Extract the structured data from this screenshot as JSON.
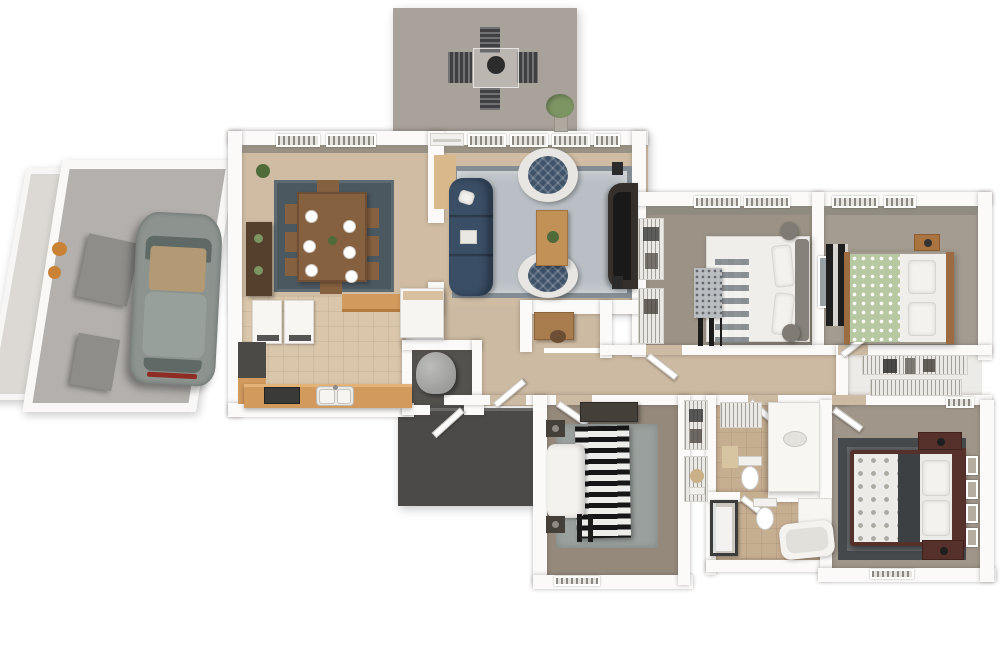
{
  "scene": {
    "type": "3d-floorplan-render",
    "description": "Top-down 3D architectural rendering of a single-story 3-bedroom, 2-bath house with attached garage and parked car, rear patio with outdoor dining set, open-plan dining and living rooms, kitchen with laundry pair, utility closet with water heater, dark concrete entry porch, central hallway, wire-shelf closets, two shared-wall bedrooms, hall bathroom, master bathroom and master bedroom",
    "background": "#ffffff",
    "visible_text": ""
  },
  "palette": {
    "background": "#ffffff",
    "wall": "#fbfaf8",
    "wall_face": "#8e897f",
    "patio_floor": "#a8a29a",
    "sideyard_floor": "#dcd9d4",
    "garage_floor": "#b3b0ad",
    "carpet_main": "#cfbca3",
    "kitchen_tile": "#d9c6ab",
    "hall_carpet": "#cdbaa2",
    "bedroom1_floor": "#9c9386",
    "bedroom2_floor": "#a49c90",
    "bedroom3_floor": "#95897b",
    "master_floor": "#a0968a",
    "bath_tile": "#c6ae91",
    "closet_floor": "#edebe7",
    "porch_concrete": "#4b4a48",
    "utility_floor": "#54524f",
    "dining_rug": "#4c5860",
    "living_rug": "#b9bfc4",
    "bedroom3_rug": "#9aa09d",
    "master_rug": "#55585b",
    "sofa_navy": "#3a4e66",
    "armchair_navy": "#3e5269",
    "chair_shell_white": "#e8e6e2",
    "wood_dark": "#55402e",
    "wood_table": "#86613f",
    "wood_light": "#c29158",
    "cabinet_wood": "#d29a5c",
    "counter_dark": "#4b4a47",
    "car_body": "#8d9490",
    "car_glass": "#5f6a66",
    "car_interior": "#b49a74",
    "car_taillight": "#8f2d24",
    "tv_dark": "#35302c",
    "speaker_dark": "#2b2b2b",
    "bed_white": "#f0eeea",
    "green_duvet": "#b7c8a3",
    "master_frame": "#56302b",
    "dark_furniture": "#453f3a",
    "grey_blanket": "#b9bdbf",
    "dark_fold": "#3d4043",
    "headboard_grey": "#86827b",
    "pouf_grey": "#7f7b74",
    "pot_orange": "#c98236",
    "plant_green": "#7d9463",
    "plant_dark": "#4f6b3a",
    "storage_grey": "#8e8d8a",
    "water_heater": "#a5a5a3",
    "porcelain": "#f7f6f3",
    "firebowl_dark": "#2c2c2c",
    "outdoor_chair": "#3f4041",
    "wood_floor_strip": "#d9b98c",
    "basket_tan": "#c9b089"
  },
  "rooms": [
    {
      "id": "patio",
      "label": "Rear patio",
      "furniture": [
        "outdoor dining table",
        "fire bowl",
        "4 slat chairs",
        "potted plant"
      ]
    },
    {
      "id": "side-yard",
      "label": "Side yard strip",
      "furniture": [
        "two orange planter pots",
        "angled grey partitions"
      ]
    },
    {
      "id": "garage",
      "label": "Garage",
      "furniture": [
        "parked grey car",
        "two grey storage units"
      ]
    },
    {
      "id": "dining-room",
      "label": "Dining room",
      "furniture": [
        "wood table with 6 place settings",
        "8 chairs",
        "dark blue-grey rug",
        "sideboard",
        "corner plant"
      ]
    },
    {
      "id": "living-room",
      "label": "Living room",
      "furniture": [
        "navy 3-seat sofa",
        "two round tub chairs",
        "wood coffee table with plant",
        "large grey rug",
        "TV console",
        "two speakers",
        "wood floor strip at patio door"
      ]
    },
    {
      "id": "kitchen",
      "label": "Kitchen / laundry",
      "furniture": [
        "washer",
        "dryer",
        "dark counter",
        "wood base cabinets",
        "double sink",
        "dark cooktop",
        "upper counter strip",
        "white island"
      ]
    },
    {
      "id": "utility-closet",
      "label": "Utility closet",
      "furniture": [
        "water heater cylinder"
      ]
    },
    {
      "id": "entry-porch",
      "label": "Entry porch (outdoor)",
      "furniture": [
        "front door leaf",
        "utility door leaf"
      ]
    },
    {
      "id": "entry-hall",
      "label": "Entry / hallway",
      "furniture": [
        "door leafs"
      ]
    },
    {
      "id": "office-nook",
      "label": "Office nook",
      "furniture": [
        "wood desk",
        "desk chair"
      ]
    },
    {
      "id": "bedroom-1",
      "label": "Bedroom 1 (top middle)",
      "furniture": [
        "bed with white and plaid bedding",
        "grey dotted throw",
        "dark luggage-rack bars",
        "two grey poufs",
        "double reach-in wire closets"
      ]
    },
    {
      "id": "bedroom-2",
      "label": "Bedroom 2 (top right)",
      "furniture": [
        "bed with green floral duvet",
        "wood head and foot rails",
        "wood nightstand with lamp",
        "dark shelf unit",
        "wall art"
      ]
    },
    {
      "id": "hall-closet",
      "label": "Walk-through wire closet",
      "furniture": [
        "two hanging-clothes shelf rows"
      ]
    },
    {
      "id": "bedroom-3",
      "label": "Bedroom 3 (bottom left)",
      "furniture": [
        "bed with black-white striped duvet",
        "white crumpled blanket",
        "grey rug",
        "dark dresser",
        "two dark nightstands",
        "dark foot bench"
      ]
    },
    {
      "id": "bathroom",
      "label": "Hall bathroom",
      "furniture": [
        "white vanity",
        "toilet",
        "wire shelf",
        "bath mat"
      ]
    },
    {
      "id": "master-bathroom",
      "label": "Master bathroom",
      "furniture": [
        "toilet",
        "bathtub",
        "glass shower with dark frame",
        "small vanity"
      ]
    },
    {
      "id": "linen-closets",
      "label": "Linen / reach-in closets",
      "furniture": [
        "wire shelves with clothes",
        "towels",
        "round basket"
      ]
    },
    {
      "id": "master-bedroom",
      "label": "Master bedroom",
      "furniture": [
        "dark-wood framed bed with grey floral bedding",
        "dark grey bordered rug",
        "two dark-wood nightstands",
        "four wall frames",
        "window"
      ]
    }
  ]
}
